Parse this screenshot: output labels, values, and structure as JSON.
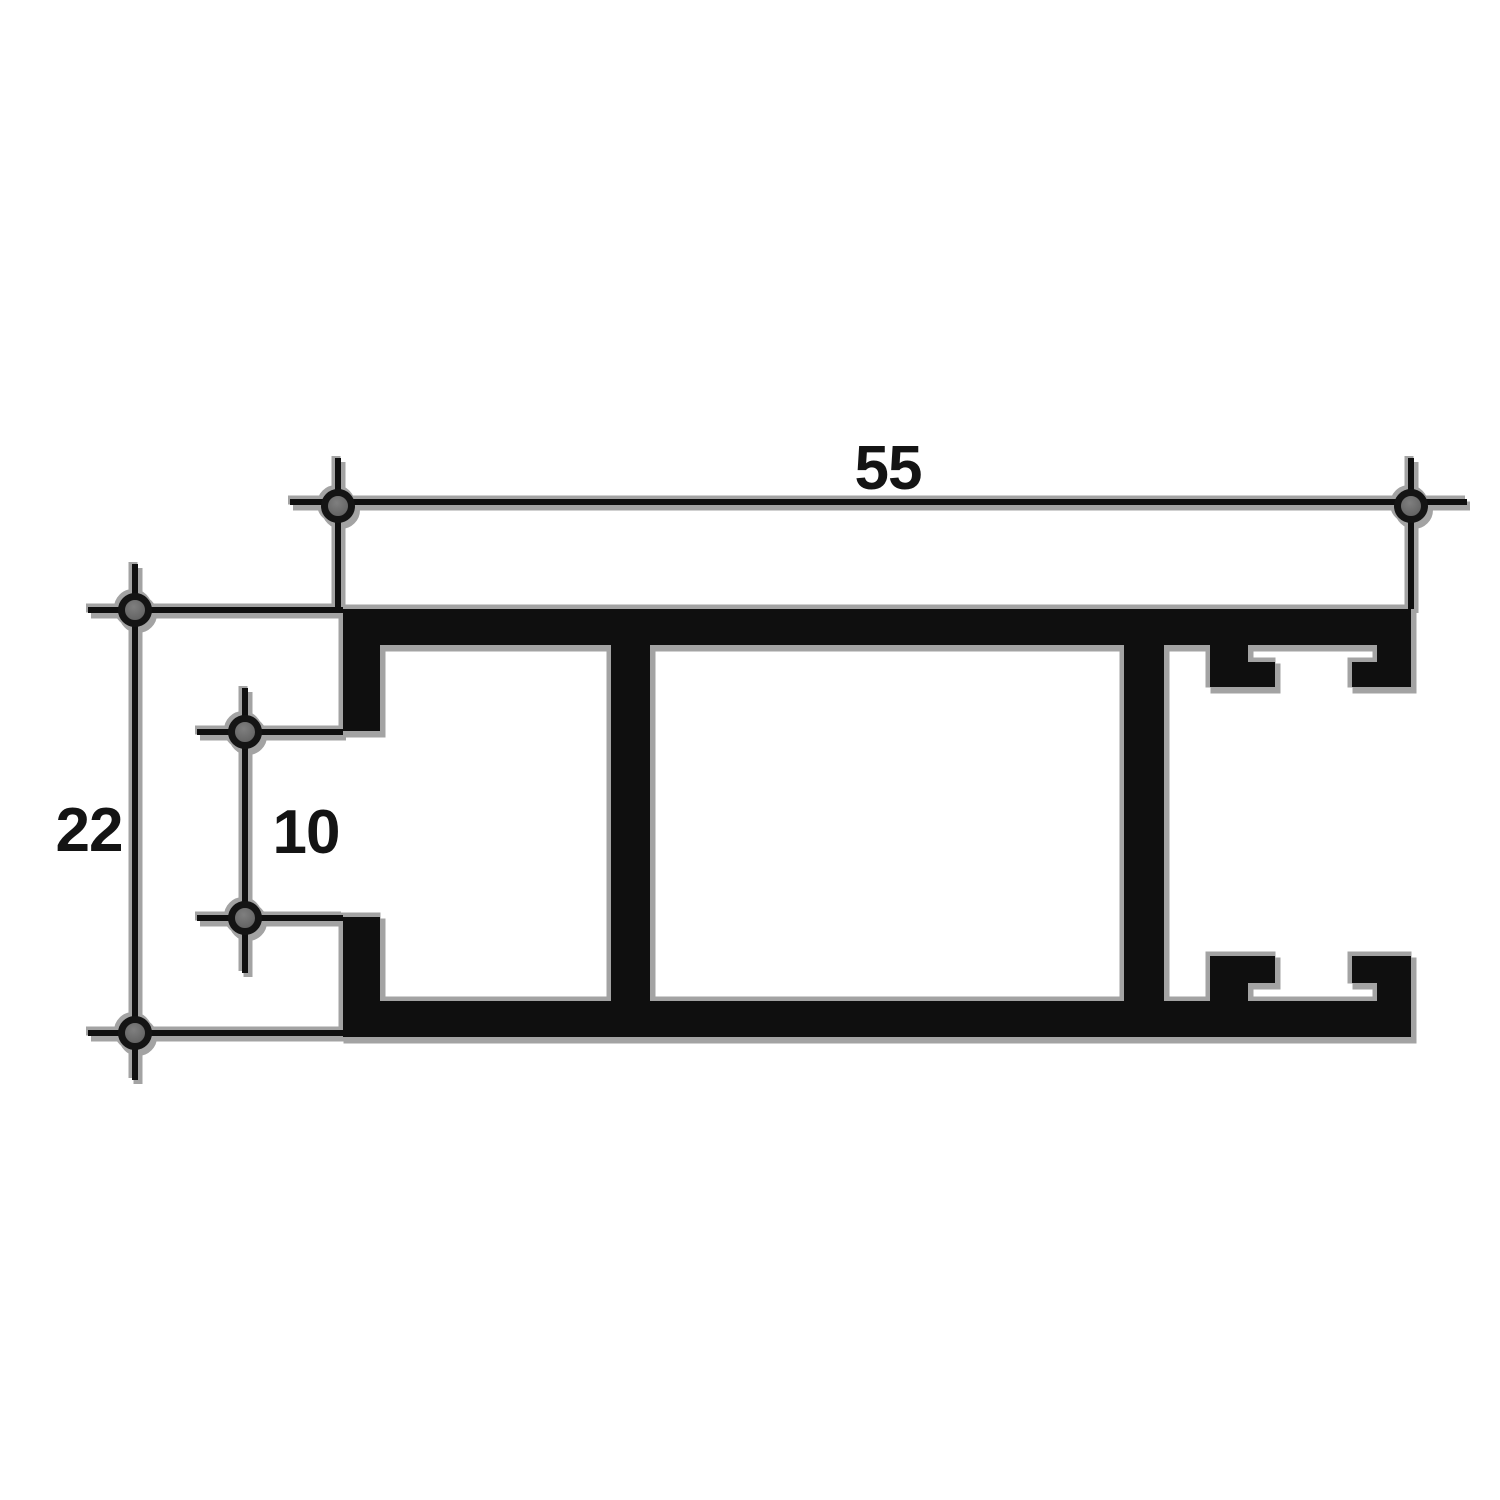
{
  "figure": {
    "kind": "profile-cross-section-technical-drawing",
    "dimension_labels": {
      "width": "55",
      "height": "22",
      "opening": "10"
    },
    "colors": {
      "ink": "#0f0f0f",
      "shadow": "#a3a3a3",
      "marker_fill": "#676767",
      "marker_ring": "#141414",
      "background": "#ffffff"
    }
  }
}
